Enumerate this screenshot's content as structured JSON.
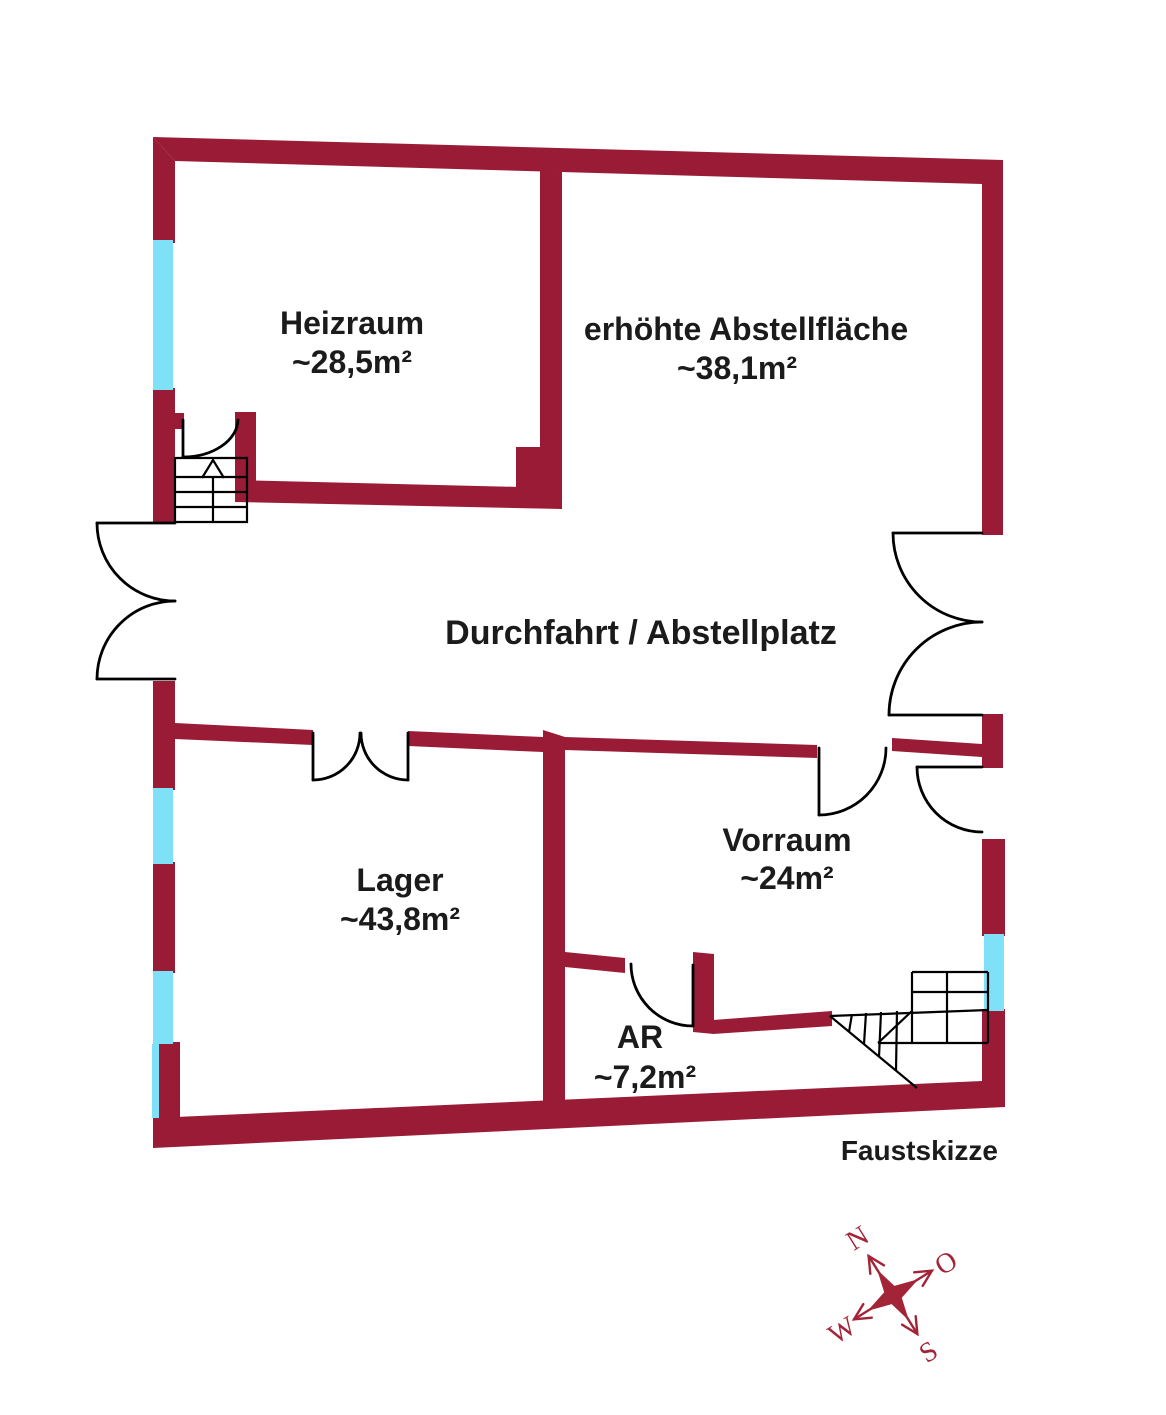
{
  "title": "Faustskizze",
  "colors": {
    "wall": "#9a1b35",
    "window": "#7fe1f8",
    "line": "#000000",
    "text": "#1b1b1b",
    "compass": "#a42437",
    "background": "#ffffff"
  },
  "rooms": {
    "heizraum": {
      "name": "Heizraum",
      "area": "~28,5m²"
    },
    "abstellflaeche": {
      "name": "erhöhte Abstellfläche",
      "area": "~38,1m²"
    },
    "durchfahrt": {
      "name": "Durchfahrt / Abstellplatz"
    },
    "lager": {
      "name": "Lager",
      "area": "~43,8m²"
    },
    "vorraum": {
      "name": "Vorraum",
      "area": "~24m²"
    },
    "ar": {
      "name": "AR",
      "area": "~7,2m²"
    }
  },
  "compass": {
    "north": "N",
    "east": "O",
    "south": "S",
    "west": "W"
  }
}
